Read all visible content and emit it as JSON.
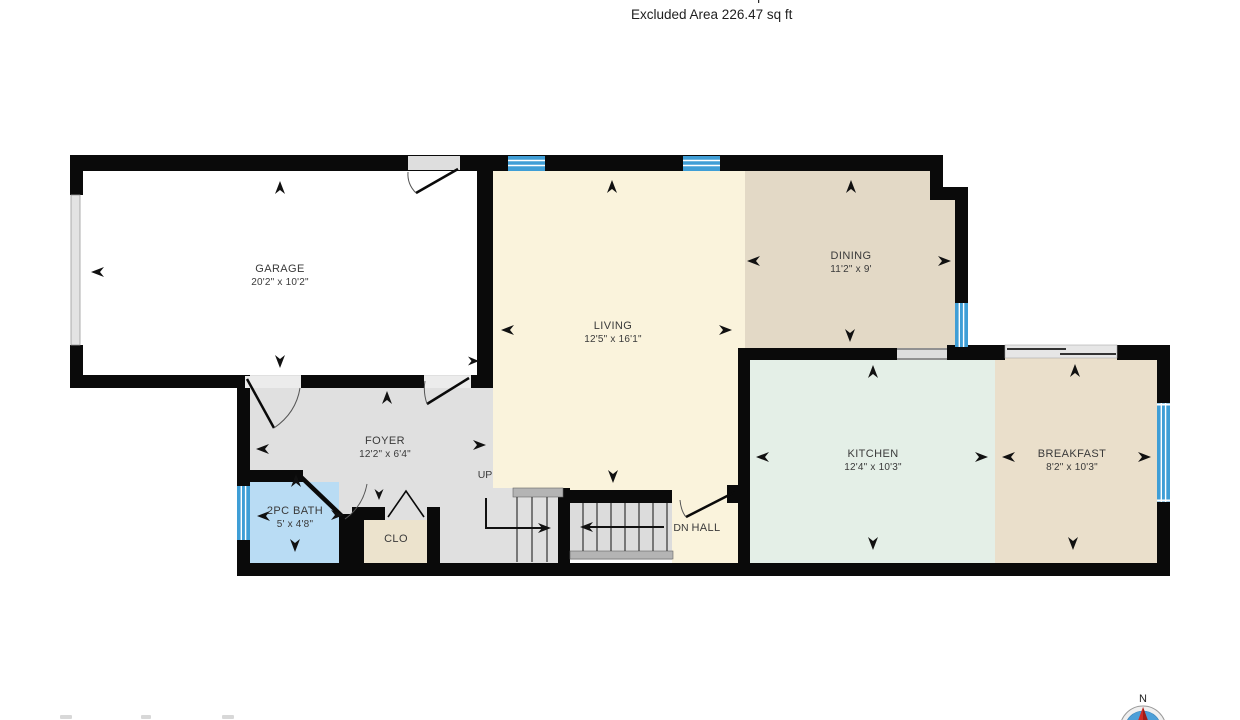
{
  "header": {
    "interior_area_line": "Interior Area 672.8 sq ft",
    "excluded_area_line": "Excluded Area 226.47 sq ft"
  },
  "rooms": {
    "garage": {
      "name": "GARAGE",
      "dims": "20'2\" x 10'2\""
    },
    "living": {
      "name": "LIVING",
      "dims": "12'5\" x 16'1\""
    },
    "dining": {
      "name": "DINING",
      "dims": "11'2\" x 9'"
    },
    "kitchen": {
      "name": "KITCHEN",
      "dims": "12'4\" x 10'3\""
    },
    "breakfast": {
      "name": "BREAKFAST",
      "dims": "8'2\" x 10'3\""
    },
    "foyer": {
      "name": "FOYER",
      "dims": "12'2\" x 6'4\""
    },
    "bath": {
      "name": "2PC BATH",
      "dims": "5' x 4'8\""
    },
    "closet": {
      "name": "CLO"
    },
    "hall": {
      "name": "HALL"
    }
  },
  "stairs": {
    "up_label": "UP",
    "down_label": "DN"
  },
  "compass": {
    "north_label": "N"
  },
  "colors": {
    "wall": "#0a0a0a",
    "garage_fill": "#ffffff",
    "living_fill": "#faf3dc",
    "dining_fill": "#e3d9c6",
    "kitchen_fill": "#e4efe7",
    "breakfast_fill": "#eadfcb",
    "foyer_fill": "#e0e0e0",
    "bath_fill": "#b9dcf4",
    "closet_fill": "#ece3cd",
    "window_blue": "#3f9ed6",
    "opening_gray": "#dedede",
    "compass_blue": "#4c9fd8",
    "compass_needle_red": "#cf2b24"
  }
}
